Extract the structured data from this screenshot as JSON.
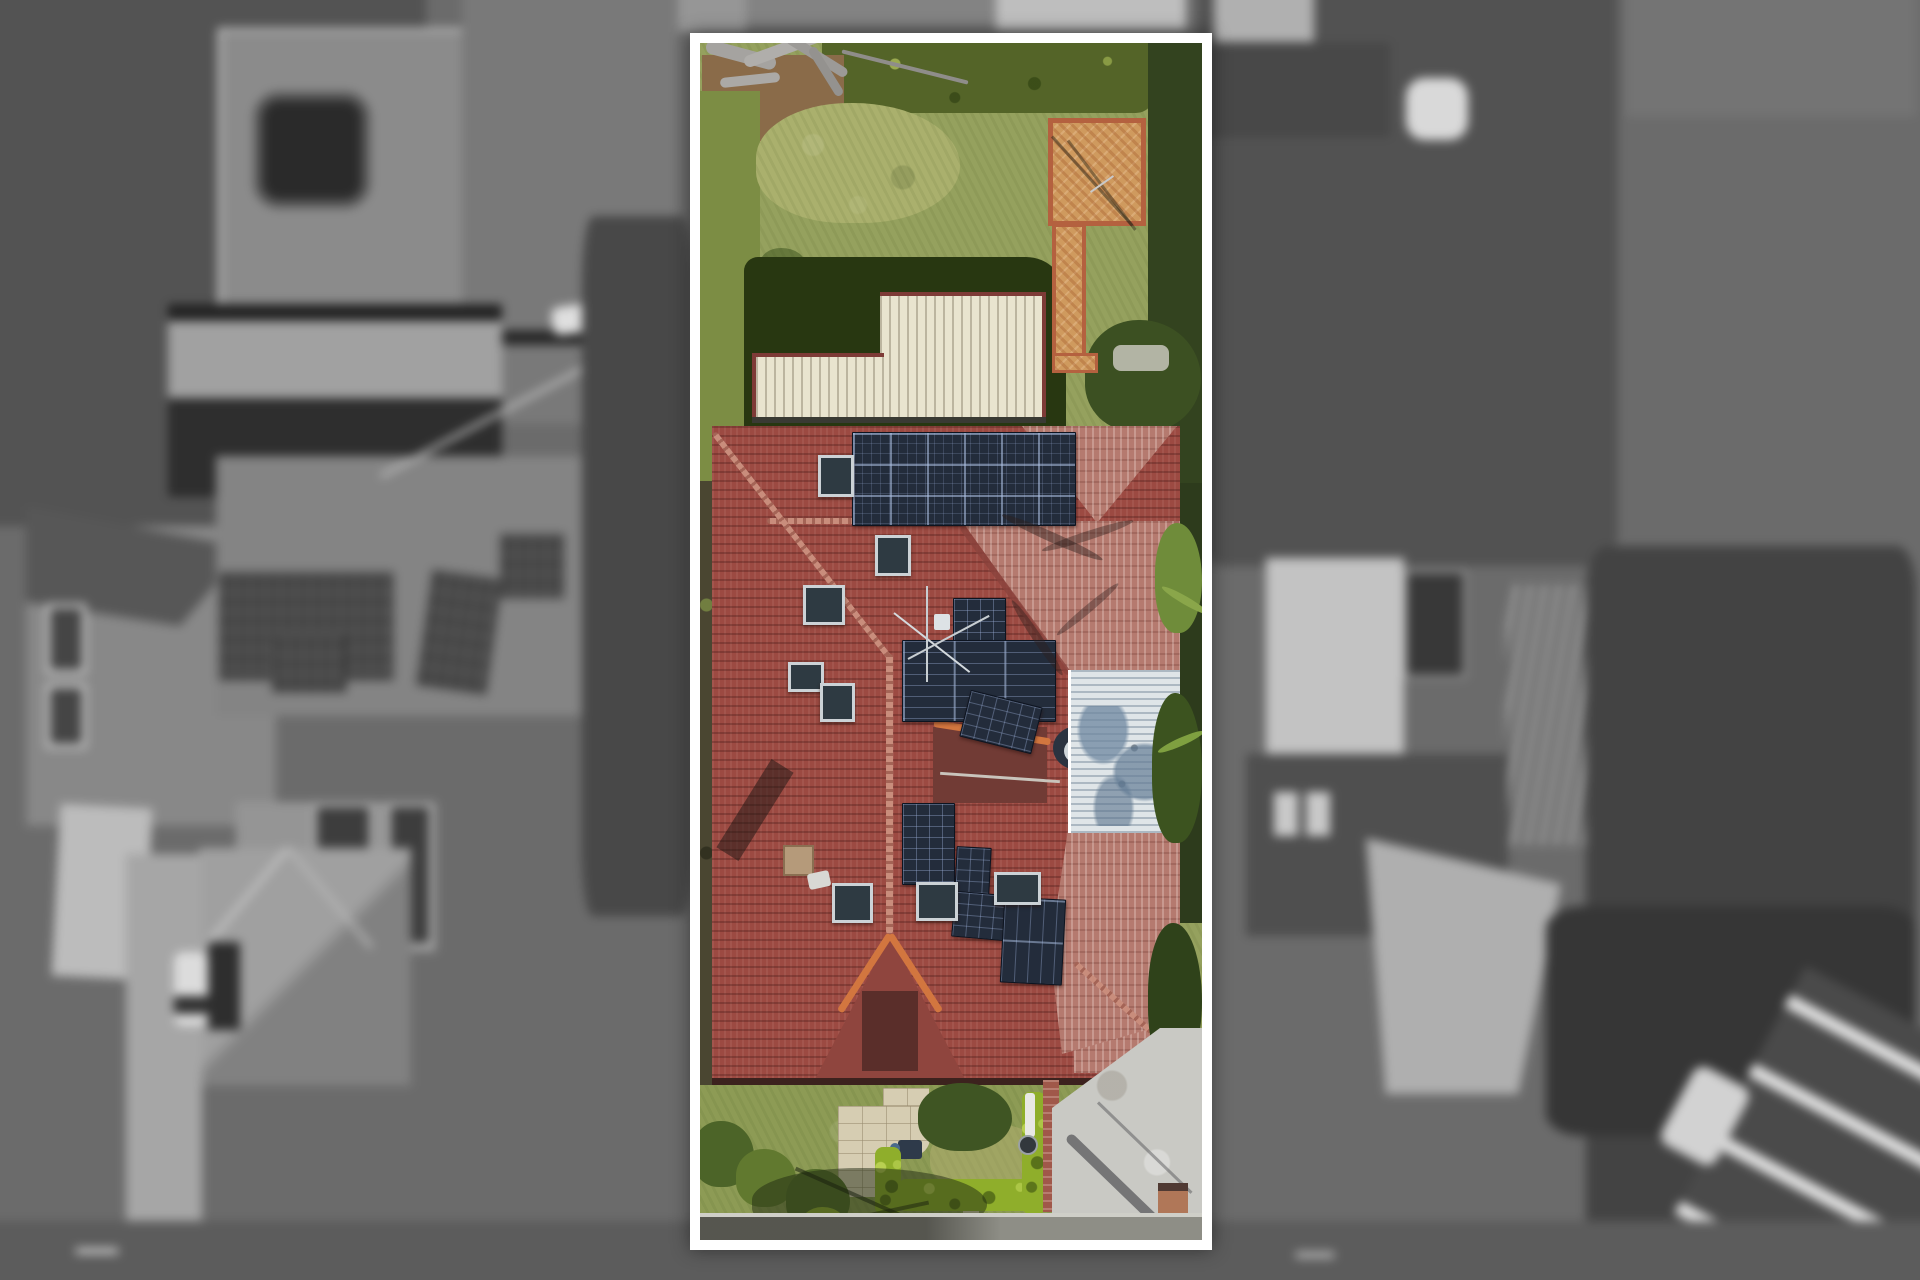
{
  "scene": {
    "type": "aerial drone photograph",
    "style": "real-estate listing image: colour property highlighted inside a white boundary frame over a blurred black-and-white neighbourhood",
    "colors": {
      "frame": "#ffffff",
      "lawn": "#95a15e",
      "lawn_front": "#8d9b55",
      "lawn_sun": "#aab06d",
      "hedge_dark": "#546428",
      "hedge_bright": "#8fae2b",
      "shadow_green": "#283711",
      "dirt": "#8a6b49",
      "brick_path": "#cf9a5e",
      "brick_border": "#b4613f",
      "cream_roof": "#e9e4cf",
      "cream_trim": "#7e3b37",
      "roof_red": "#9c4a42",
      "roof_pink": "#b57a6f",
      "roof_dark": "#8a423c",
      "ridge_light": "#c98d7c",
      "ridge_orange": "#d2763f",
      "solar_panel": "#232c3b",
      "skylight": "#2e3a42",
      "silver_roof": "#dfe5e8",
      "palm_green": "#6f8c3a",
      "driveway": "#c9c9c4",
      "road": "#8e8e86",
      "paver": "#d6cdb2",
      "letterbox_brick": "#b07758",
      "bg_base": "#6e6e6e",
      "bg_trees": "#3e3e3e",
      "bg_roof": "#9f9f9f"
    },
    "property": {
      "boundary": "white rectangular highlight frame",
      "backyard": [
        "dead driftwood branches",
        "garden bed with timber edging",
        "rear hedge",
        "side hedge",
        "lawn",
        "L-shaped terracotta brick path and patio",
        "clothesline shadow"
      ],
      "house": [
        "cream corrugated garage roof",
        "large terracotta tiled hip roof",
        "top solar array 6x3 panels",
        "mid roof solar cluster 7 panels",
        "lower roof solar cluster 7 panels",
        "8 skylights",
        "chimney with shadow",
        "tv antenna",
        "satellite dish",
        "silver metal patio roof with palm shadow",
        "front gable with orange ridge capping",
        "palm trees along right boundary"
      ],
      "frontyard": [
        "beige paver path",
        "garden tree",
        "wheelie bin",
        "bright topiary hedge rows",
        "round shrubs",
        "tree shadow",
        "brick letterbox pillar",
        "concrete driveway with power-pole shadow",
        "street verge"
      ]
    },
    "surroundings": [
      "blurred grayscale houses",
      "above-ground pool in yard",
      "large corrugated shed",
      "neighbour rooftop solar arrays",
      "hip-roof house",
      "driveways and cars",
      "pergola",
      "dense trees",
      "street at bottom"
    ]
  }
}
